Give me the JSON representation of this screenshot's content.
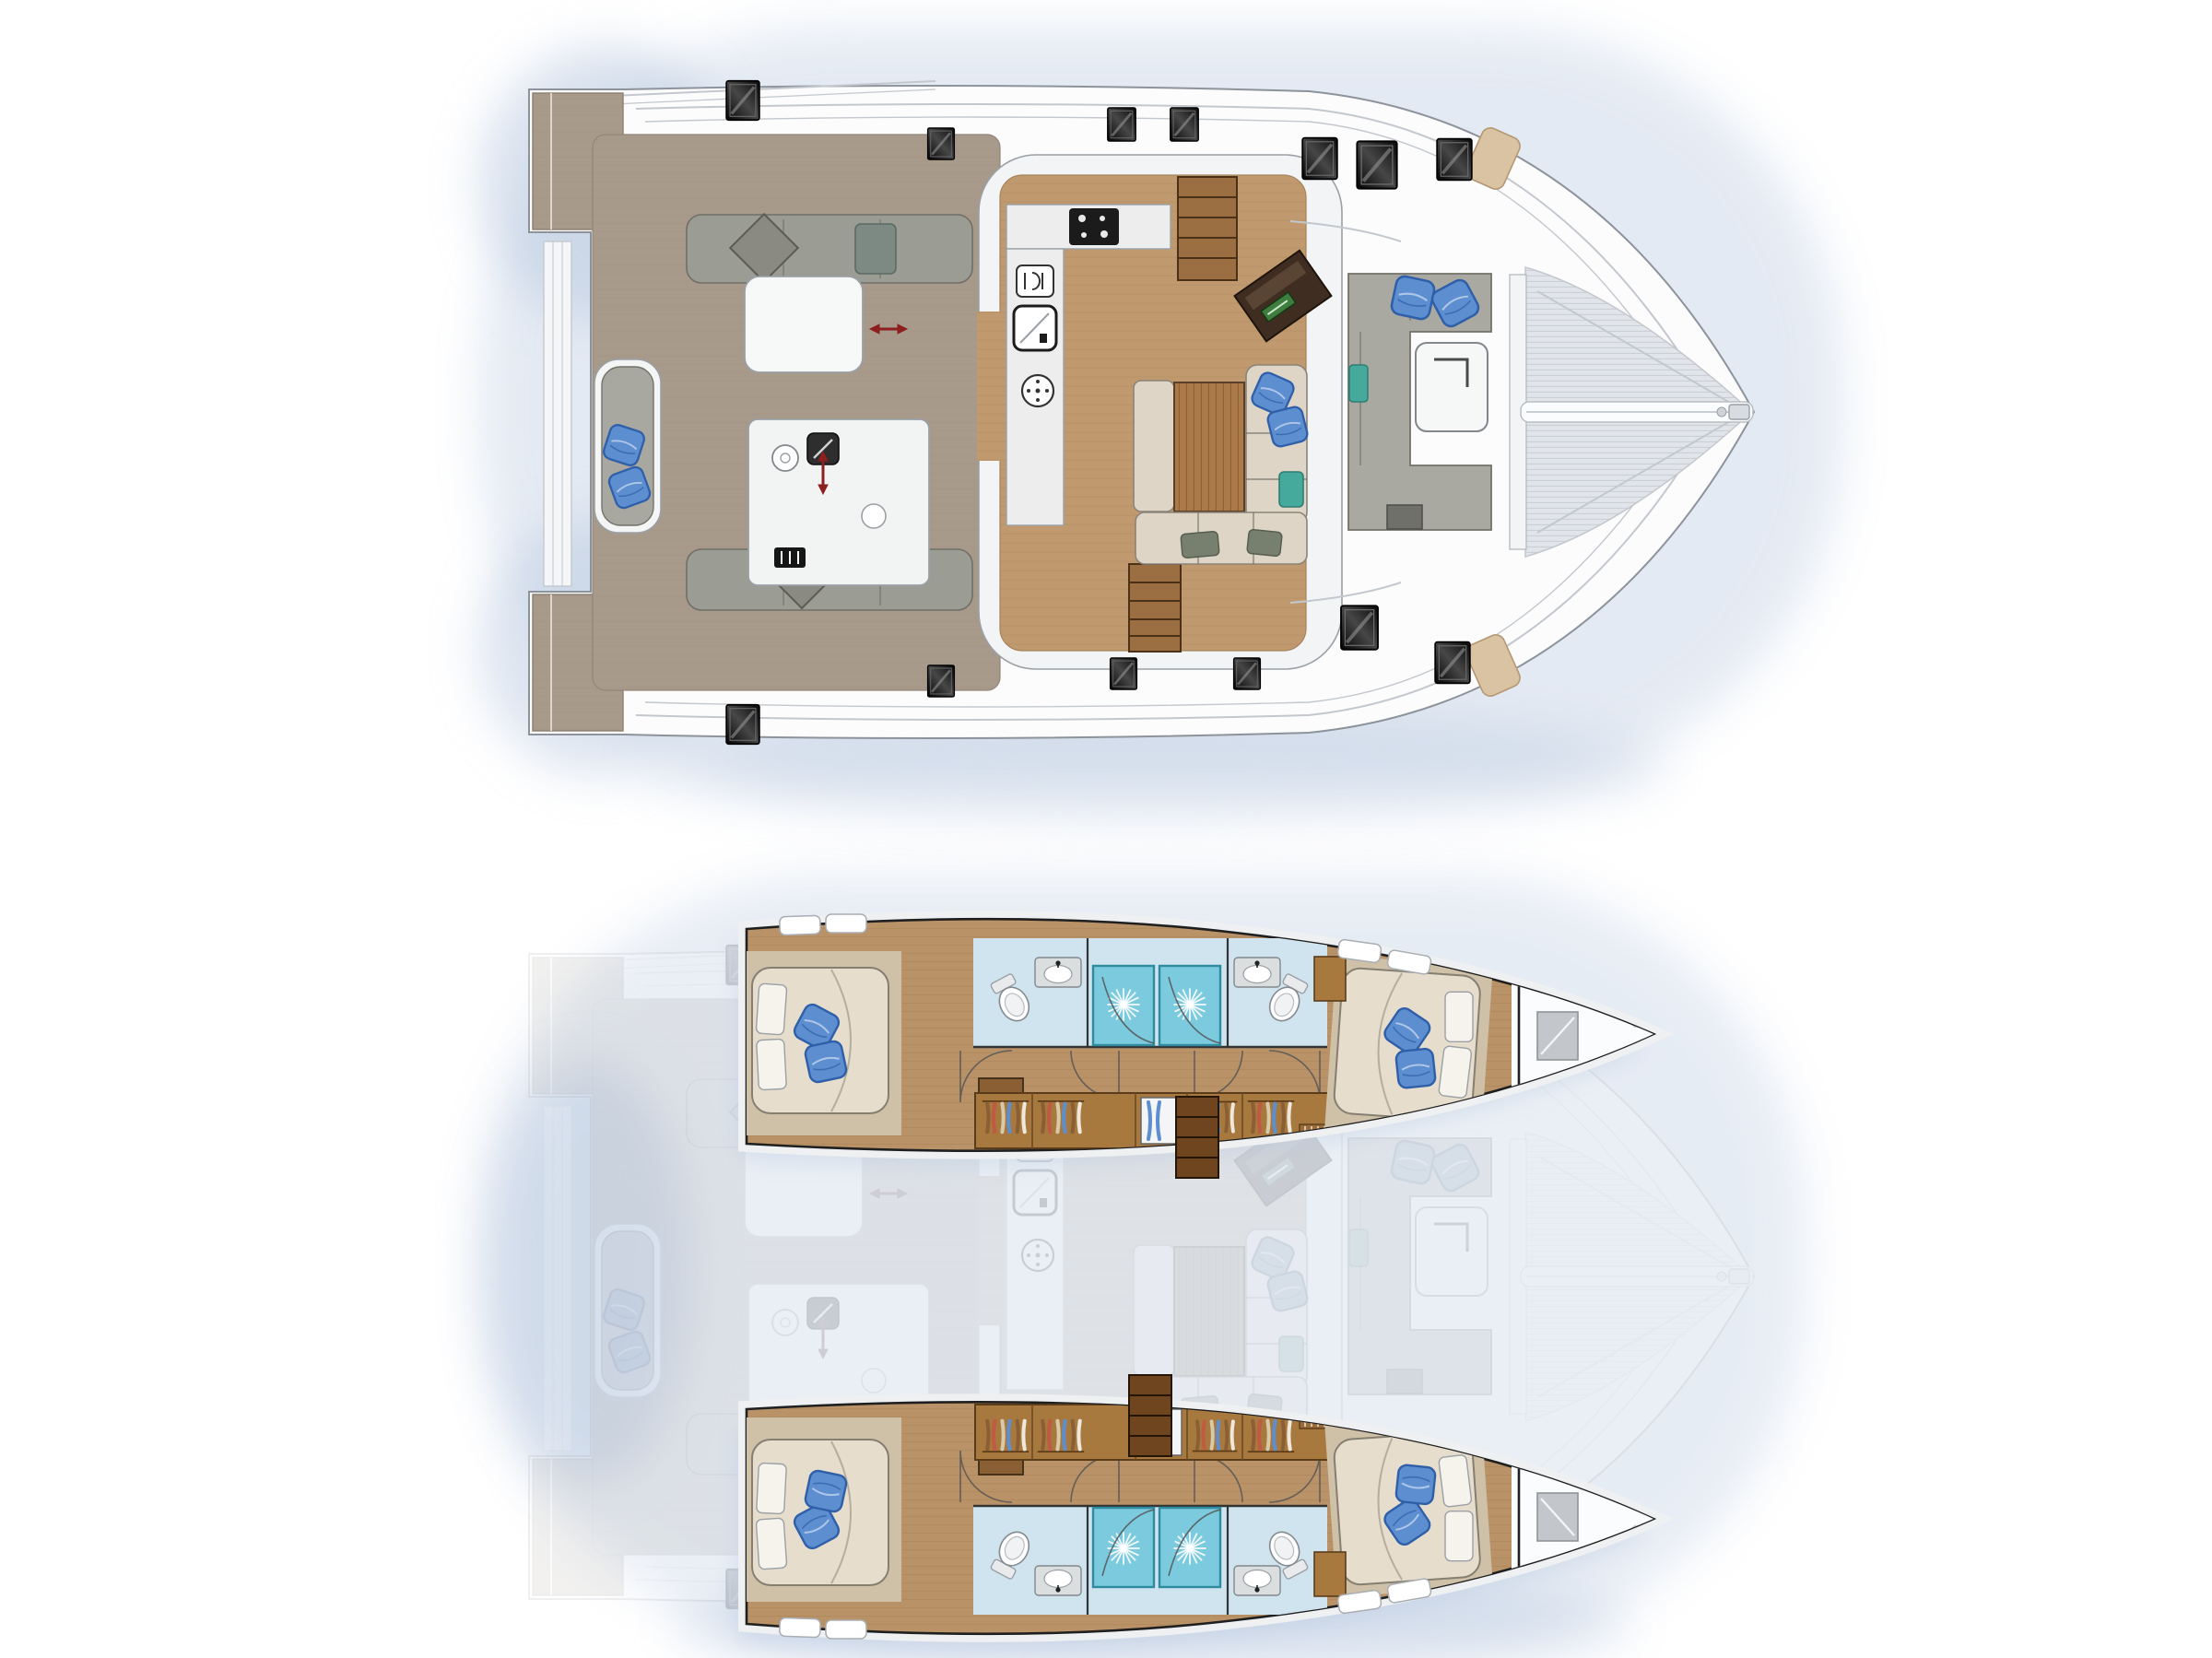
{
  "document": {
    "aria_title": "Catamaran yacht floor plan — upper deck and saloon level (top) and hull accommodation level with four cabins and four bathrooms (bottom)"
  },
  "colors": {
    "bg": "#ffffff",
    "halo": "#d8e3f1",
    "shadow": "#b9c9e0",
    "hull": "#fcfcfd",
    "hull_line": "#8d939b",
    "detail": "#c3c8ce",
    "black": "#1f1f1f",
    "teak": "#a89a8a",
    "teak_line": "#90837622",
    "platform": "#9c8e7e",
    "wood": "#c09a6e",
    "wood_line": "#a8855c55",
    "table_wood": "#aa7a48",
    "stair": "#9c6f42",
    "stair_dark": "#6f451f",
    "counter": "#ededee",
    "counter_line": "#9aa0a6",
    "cooktop": "#1b1b1b",
    "seat_gray": "#9b9c94",
    "seat_gray2": "#a9a9a1",
    "seat_line": "#72726a",
    "sofa": "#ded5c6",
    "sofa_line": "#8a8378",
    "pillow": "#5d8ed0",
    "pillow_line": "#2f5fa8",
    "pillow_white": "#f6f3ec",
    "teal": "#45a99c",
    "sage": "#77806f",
    "tramp": "#e1e4e9",
    "tramp_line": "#c9cdd4",
    "vent": "#d9c3a3",
    "nav_desk": "#3f2d22",
    "nav_green": "#3e7d3e",
    "red": "#8e1f1f",
    "cabin_floor": "#b99267",
    "cabin_floor_line": "#a07c5055",
    "bed": "#e6ddcd",
    "bed_base": "#cfc0a8",
    "bed_line": "#857f72",
    "tile": "#cfe4ee",
    "shower": "#7ccade",
    "shower_line": "#2f8ba0",
    "fixture": "#dadedf",
    "wardrobe": "#a8793f",
    "wardrobe_line": "#5a3c1a",
    "cabinet": "#8a5f33",
    "forepeak_hatch": "#c3c7cb",
    "ghost_opacity": "0.16"
  },
  "views": [
    {
      "name": "Upper deck and saloon plan",
      "areas": [
        "swim platforms",
        "aft cockpit",
        "cockpit lounge",
        "cockpit table",
        "outdoor galley",
        "saloon",
        "galley",
        "navigation station",
        "dinette",
        "forward cockpit",
        "foredeck",
        "trampoline",
        "bowsprit"
      ]
    },
    {
      "name": "Hull accommodation plan",
      "areas": [
        "port aft cabin",
        "port bathrooms",
        "port wardrobes",
        "port forward cabin",
        "starboard aft cabin",
        "starboard bathrooms",
        "starboard wardrobes",
        "starboard forward cabin",
        "companionway stairs",
        "forepeak locker",
        "ghosted saloon overlay"
      ]
    }
  ],
  "inventory": {
    "hulls": 2,
    "levels_shown": 2,
    "double_berths": 4,
    "bathrooms": 4,
    "shower_stalls": 4,
    "toilets": 4,
    "wash_basins": 4,
    "deck_hatches": 13,
    "companionway_stairs": 2,
    "blue_throw_pillows": 14
  }
}
